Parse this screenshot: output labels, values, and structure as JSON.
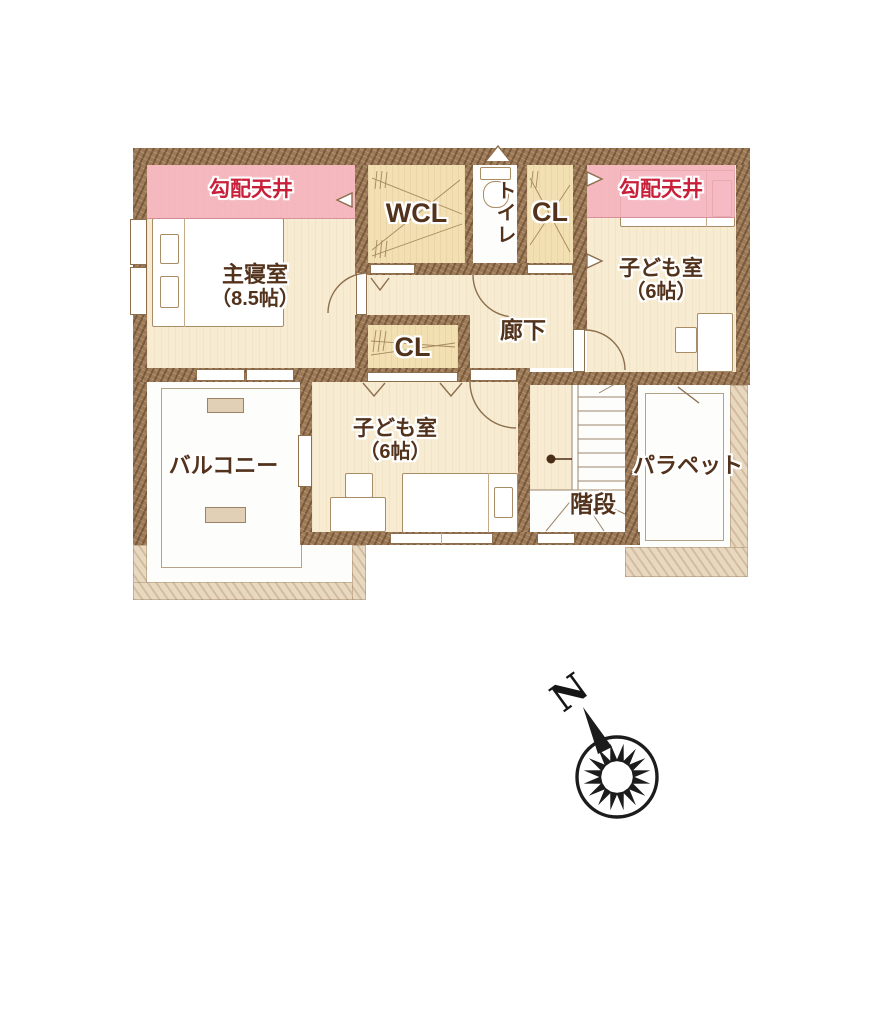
{
  "plan": {
    "banners": {
      "left": "勾配天井",
      "right": "勾配天井"
    },
    "rooms": {
      "master": {
        "name": "主寝室",
        "size": "（8.5帖）"
      },
      "wcl": {
        "name": "WCL"
      },
      "toilet": {
        "name": "トイレ"
      },
      "closet_top": {
        "name": "CL"
      },
      "child_right": {
        "name": "子ども室",
        "size": "（6帖）"
      },
      "hallway": {
        "name": "廊下"
      },
      "closet_mid": {
        "name": "CL"
      },
      "child_bottom": {
        "name": "子ども室",
        "size": "（6帖）"
      },
      "stairs": {
        "name": "階段"
      },
      "balcony": {
        "name": "バルコニー"
      },
      "parapet": {
        "name": "パラペット"
      }
    },
    "compass": {
      "north": "N"
    },
    "colors": {
      "wall": "#9c7a57",
      "floor_cream": "#f7ecd2",
      "floor_closet": "#f2dfb2",
      "banner_bg": "#f3afba",
      "banner_text": "#c9203a",
      "label_text": "#53321c",
      "parapet_band": "#e9d8c0"
    }
  }
}
